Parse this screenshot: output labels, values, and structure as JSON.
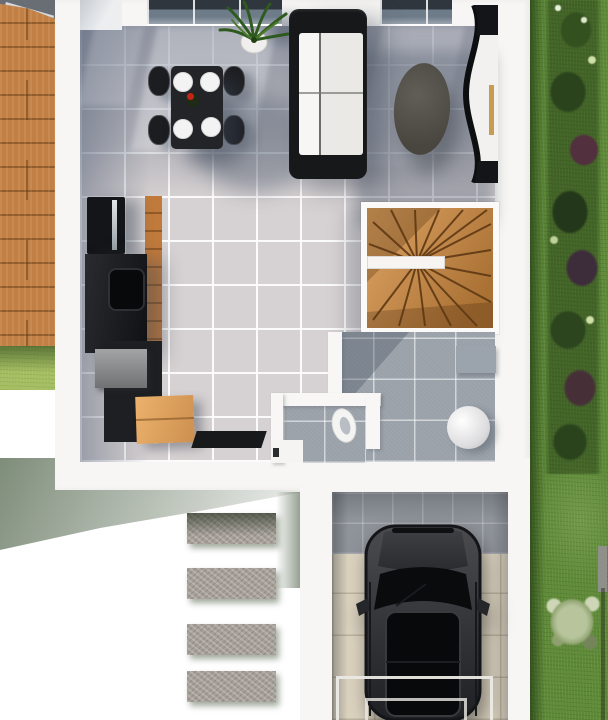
{
  "scene": {
    "title": "Ground floor 3D plan with garage",
    "view_label": "Top-down 3D architectural rendering"
  },
  "rooms": {
    "living": {
      "label": "Living / dining room"
    },
    "kitchen": {
      "label": "Kitchen"
    },
    "staircase": {
      "label": "Winder staircase"
    },
    "hallway": {
      "label": "Hallway"
    },
    "wc": {
      "label": "WC"
    },
    "garage": {
      "label": "Garage"
    },
    "deck": {
      "label": "Wooden terrace"
    },
    "lawn": {
      "label": "Lawn"
    },
    "garden_border": {
      "label": "Garden shrub border"
    },
    "path": {
      "label": "Stepping stone path"
    }
  },
  "furniture": {
    "dining_table": {
      "label": "Dining table"
    },
    "dining_chair": {
      "label": "Dining chair"
    },
    "plate": {
      "label": "Place setting"
    },
    "centerpiece": {
      "label": "Red flower centerpiece",
      "color": "#c22517"
    },
    "sofa": {
      "label": "Two-seat sofa"
    },
    "coffee_table": {
      "label": "Oval coffee table"
    },
    "tv_unit": {
      "label": "Curved TV cabinet"
    },
    "plant": {
      "label": "Potted plant"
    },
    "fridge": {
      "label": "Tall fridge unit"
    },
    "counter": {
      "label": "Kitchen counter with sink"
    },
    "sink": {
      "label": "Sink"
    },
    "appliance": {
      "label": "Countertop appliance"
    },
    "box": {
      "label": "Cardboard box"
    },
    "doormat": {
      "label": "Doormat"
    },
    "toilet": {
      "label": "Toilet"
    },
    "water_heater": {
      "label": "Water heater"
    },
    "side_cabinet": {
      "label": "Wall cabinet"
    },
    "car": {
      "label": "Parked SUV",
      "color": "#2b2c2e"
    },
    "garage_door": {
      "label": "Garage door threshold"
    },
    "stepping_stone": {
      "label": "Stepping stone"
    },
    "parasol": {
      "label": "Parasol edge"
    },
    "stair_rail": {
      "label": "Stair railing"
    },
    "bush": {
      "label": "Shrub"
    },
    "sage_bush": {
      "label": "Sage green shrub"
    },
    "post": {
      "label": "Garden post"
    }
  },
  "counts": {
    "dining_chairs": 4,
    "plates": 4,
    "stepping_stones": 4
  },
  "palette": {
    "floor_tile": "#d6d1d2",
    "tile_shadow_blue": "#5c6a80",
    "wall_white": "#f7f6f4",
    "deck_wood": "#c28044",
    "stair_wood": "#c9924f",
    "kitchen_wood": "#c07a3c",
    "grass_light": "#a4be61",
    "grass_deep": "#5e8a38",
    "furniture_black": "#17181a",
    "hall_tile_gray": "#9aa1a9",
    "garage_floor_beige": "#dcd3bf",
    "garage_tile_gray": "#8f939a",
    "car_charcoal": "#2b2c2e",
    "box_cardboard": "#e0a35f",
    "window_glass": "#39414b"
  }
}
